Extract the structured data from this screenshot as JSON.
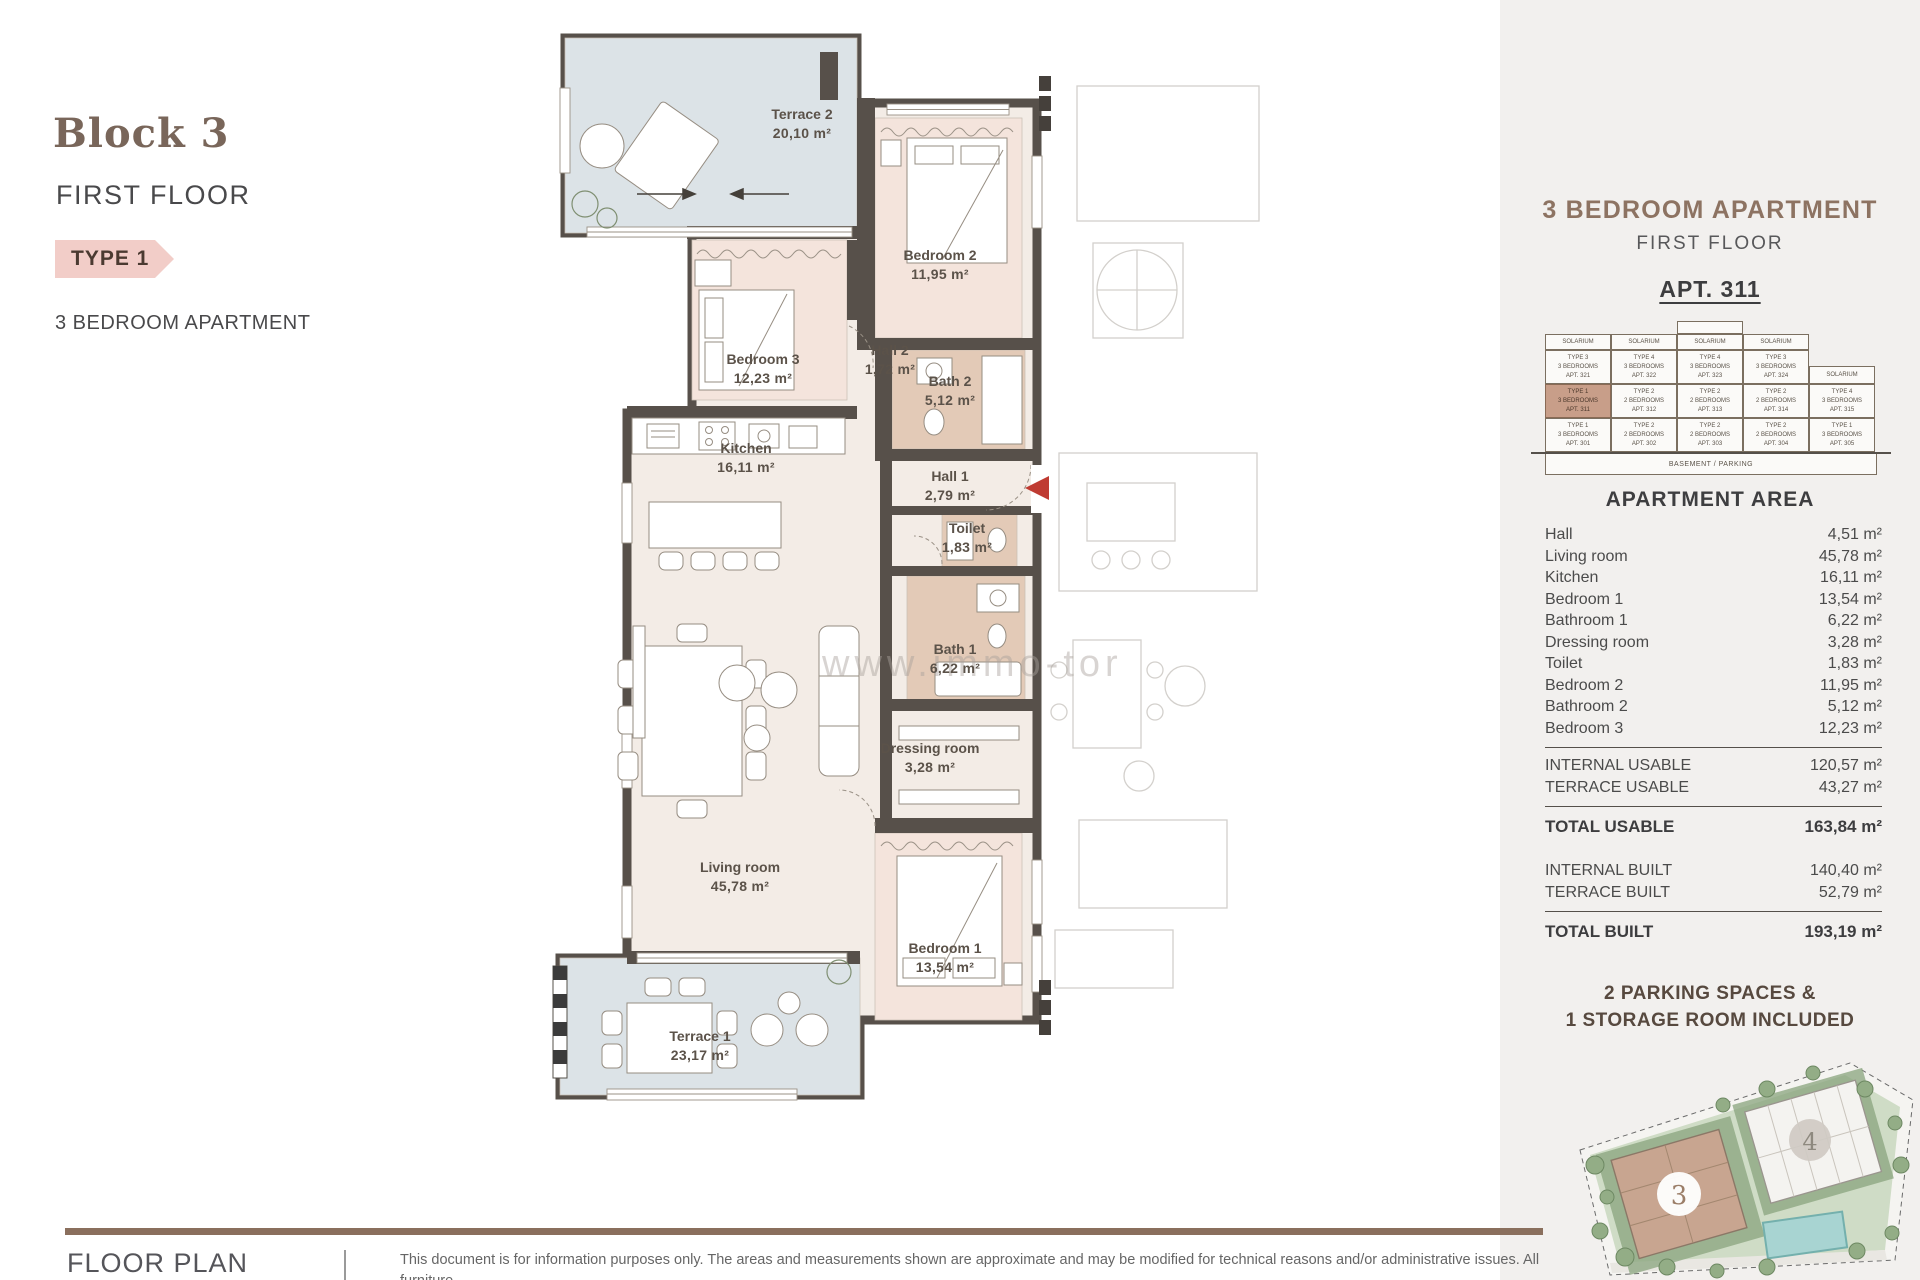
{
  "header": {
    "block_title": "Block 3",
    "floor": "FIRST FLOOR",
    "type_tag": "TYPE 1",
    "apartment_type": "3 BEDROOM APARTMENT"
  },
  "floorplan": {
    "watermark": "www.immo-tor",
    "rooms": [
      {
        "name": "Terrace 2",
        "area": "20,10 m²"
      },
      {
        "name": "Bedroom 2",
        "area": "11,95 m²"
      },
      {
        "name": "Bedroom 3",
        "area": "12,23 m²"
      },
      {
        "name": "Hall 2",
        "area": "1,72 m²"
      },
      {
        "name": "Bath 2",
        "area": "5,12 m²"
      },
      {
        "name": "Kitchen",
        "area": "16,11 m²"
      },
      {
        "name": "Hall 1",
        "area": "2,79 m²"
      },
      {
        "name": "Toilet",
        "area": "1,83 m²"
      },
      {
        "name": "Bath 1",
        "area": "6,22 m²"
      },
      {
        "name": "Dressing room",
        "area": "3,28 m²"
      },
      {
        "name": "Living room",
        "area": "45,78 m²"
      },
      {
        "name": "Bedroom 1",
        "area": "13,54 m²"
      },
      {
        "name": "Terrace 1",
        "area": "23,17 m²"
      }
    ]
  },
  "sidebar": {
    "title": "3 BEDROOM APARTMENT",
    "subtitle": "FIRST FLOOR",
    "apt_label": "APT. 311",
    "building_diagram": {
      "solarium_label": "SOLARIUM",
      "basement_label": "BASEMENT / PARKING",
      "floors": [
        {
          "cells": [
            {
              "lines": [
                "TYPE 3",
                "3 BEDROOMS",
                "APT. 321"
              ]
            },
            {
              "lines": [
                "TYPE 4",
                "3 BEDROOMS",
                "APT. 322"
              ]
            },
            {
              "lines": [
                "TYPE 4",
                "3 BEDROOMS",
                "APT. 323"
              ]
            },
            {
              "lines": [
                "TYPE 3",
                "3 BEDROOMS",
                "APT. 324"
              ]
            },
            {
              "solarium": true
            }
          ]
        },
        {
          "cells": [
            {
              "lines": [
                "TYPE 1",
                "3 BEDROOMS",
                "APT. 311"
              ],
              "highlight": true
            },
            {
              "lines": [
                "TYPE 2",
                "2 BEDROOMS",
                "APT. 312"
              ]
            },
            {
              "lines": [
                "TYPE 2",
                "2 BEDROOMS",
                "APT. 313"
              ]
            },
            {
              "lines": [
                "TYPE 2",
                "2 BEDROOMS",
                "APT. 314"
              ]
            },
            {
              "lines": [
                "TYPE 4",
                "3 BEDROOMS",
                "APT. 315"
              ]
            }
          ]
        },
        {
          "cells": [
            {
              "lines": [
                "TYPE 1",
                "3 BEDROOMS",
                "APT. 301"
              ]
            },
            {
              "lines": [
                "TYPE 2",
                "2 BEDROOMS",
                "APT. 302"
              ]
            },
            {
              "lines": [
                "TYPE 2",
                "2 BEDROOMS",
                "APT. 303"
              ]
            },
            {
              "lines": [
                "TYPE 2",
                "2 BEDROOMS",
                "APT. 304"
              ]
            },
            {
              "lines": [
                "TYPE 1",
                "3 BEDROOMS",
                "APT. 305"
              ]
            }
          ]
        }
      ]
    },
    "area_section": {
      "title": "APARTMENT AREA",
      "rooms": [
        {
          "label": "Hall",
          "value": "4,51 m²"
        },
        {
          "label": "Living room",
          "value": "45,78 m²"
        },
        {
          "label": "Kitchen",
          "value": "16,11 m²"
        },
        {
          "label": "Bedroom 1",
          "value": "13,54 m²"
        },
        {
          "label": "Bathroom 1",
          "value": "6,22 m²"
        },
        {
          "label": "Dressing room",
          "value": "3,28 m²"
        },
        {
          "label": "Toilet",
          "value": "1,83 m²"
        },
        {
          "label": "Bedroom 2",
          "value": "11,95 m²"
        },
        {
          "label": "Bathroom 2",
          "value": "5,12 m²"
        },
        {
          "label": "Bedroom 3",
          "value": "12,23 m²"
        }
      ],
      "summary": [
        {
          "label": "INTERNAL USABLE",
          "value": "120,57 m²",
          "divider_before": true
        },
        {
          "label": "TERRACE USABLE",
          "value": "43,27 m²"
        },
        {
          "label": "TOTAL USABLE",
          "value": "163,84 m²",
          "bold": true,
          "divider_before": true
        },
        {
          "label": "INTERNAL BUILT",
          "value": "140,40 m²",
          "gap_before": true
        },
        {
          "label": "TERRACE BUILT",
          "value": "52,79 m²"
        },
        {
          "label": "TOTAL BUILT",
          "value": "193,19 m²",
          "bold": true,
          "divider_before": true
        }
      ]
    },
    "parking_note_line1": "2 PARKING SPACES &",
    "parking_note_line2": "1 STORAGE ROOM INCLUDED",
    "siteplan": {
      "block3_label": "3",
      "block4_label": "4"
    }
  },
  "footer": {
    "section_label": "FLOOR PLAN",
    "disclaimer_line1": "This document is for information purposes only. The areas and measurements shown are approximate and may be modified for technical reasons and/or administrative issues. All furniture",
    "disclaimer_line2": "shown is for illustrative purposes. *Prices do not include taxes, legal fees, stamp duties and notary fees associated with the purchase. This is an informative document, not part of any contract."
  },
  "colors": {
    "accent_pink": "#f2cdc8",
    "heading_brown": "#8d7362",
    "wall": "#57504a",
    "terrace_fill": "#dce3e7",
    "bedroom_fill": "#f4e4dc",
    "wet_fill": "#e3cab7",
    "floor_fill": "#f3ece6",
    "highlight_cell": "#c89e89",
    "entrance_red": "#bf3b32",
    "rule_brown": "#8a6f5d",
    "sidebar_bg": "#f2f0ee"
  }
}
